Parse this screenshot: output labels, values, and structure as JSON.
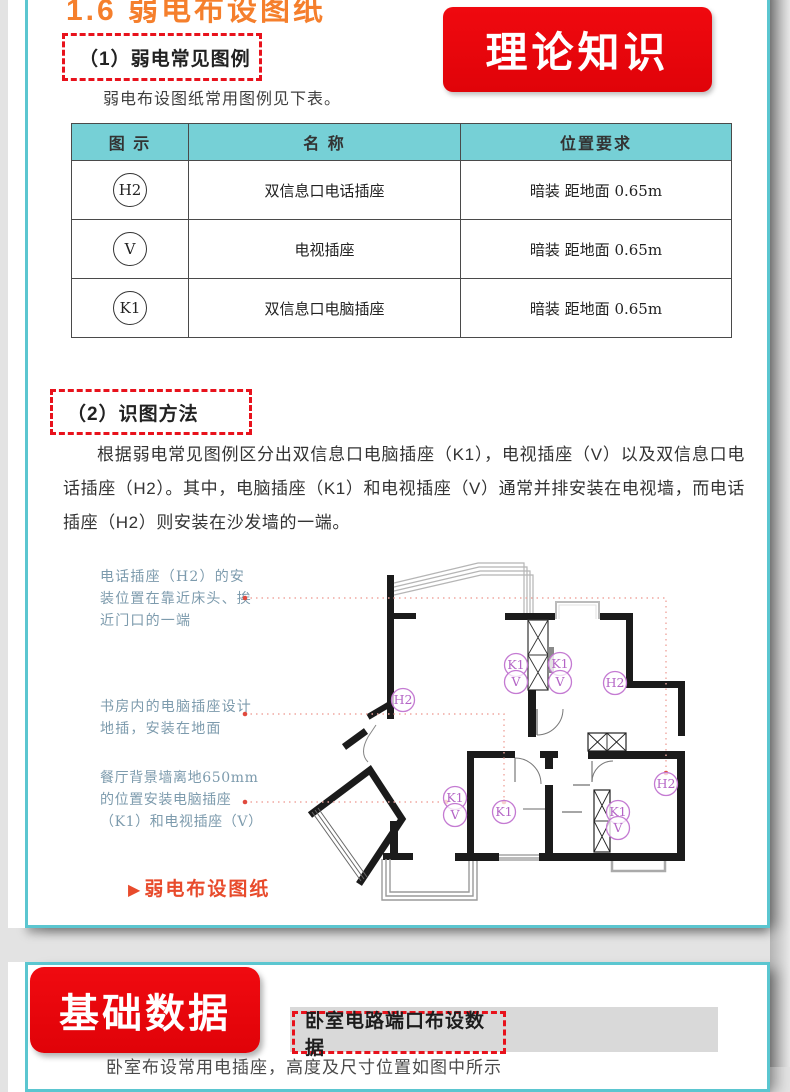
{
  "header": {
    "section_title": "1.6 弱电布设图纸",
    "badge": "理论知识"
  },
  "legend": {
    "title": "（1）弱电常见图例",
    "intro": "弱电布设图纸常用图例见下表。",
    "table": {
      "headers": [
        "图 示",
        "名 称",
        "位置要求"
      ],
      "rows": [
        {
          "symbol": "H2",
          "name": "双信息口电话插座",
          "requirement": "暗装 距地面 0.65m"
        },
        {
          "symbol": "V",
          "name": "电视插座",
          "requirement": "暗装 距地面 0.65m"
        },
        {
          "symbol": "K1",
          "name": "双信息口电脑插座",
          "requirement": "暗装 距地面 0.65m"
        }
      ]
    }
  },
  "method": {
    "title": "（2）识图方法",
    "paragraph": "根据弱电常见图例区分出双信息口电脑插座（K1），电视插座（V）以及双信息口电话插座（H2）。其中，电脑插座（K1）和电视插座（V）通常并排安装在电视墙，而电话插座（H2）则安装在沙发墙的一端。"
  },
  "figure": {
    "annotations": [
      {
        "lines": [
          "电话插座（H2）的安",
          "装位置在靠近床头、挨",
          "近门口的一端"
        ]
      },
      {
        "lines": [
          "书房内的电脑插座设计",
          "地插，安装在地面"
        ]
      },
      {
        "lines": [
          "餐厅背景墙离地650mm",
          "的位置安装电脑插座",
          "（K1）和电视插座（V）"
        ]
      }
    ],
    "caption_icon": "▶",
    "caption": "弱电布设图纸",
    "plan_labels": [
      "K1",
      "V",
      "K1",
      "V",
      "H2",
      "H2",
      "K1",
      "V",
      "K1",
      "K1",
      "V",
      "H2"
    ]
  },
  "basic": {
    "badge": "基础数据",
    "bar_title": "卧室电路端口布设数据",
    "partial_text": "卧室布设常用电插座，高度及尺寸位置如图中所示"
  },
  "colors": {
    "accent_red": "#e8121c",
    "banner_red": "#ec090d",
    "teal_border": "#5bc6d0",
    "table_header_teal": "#76d0d6",
    "title_orange": "#f57f2c",
    "annotation_blue": "#7d9bad",
    "plan_label_purple": "#b465c6",
    "caption_red": "#e84b2c"
  }
}
